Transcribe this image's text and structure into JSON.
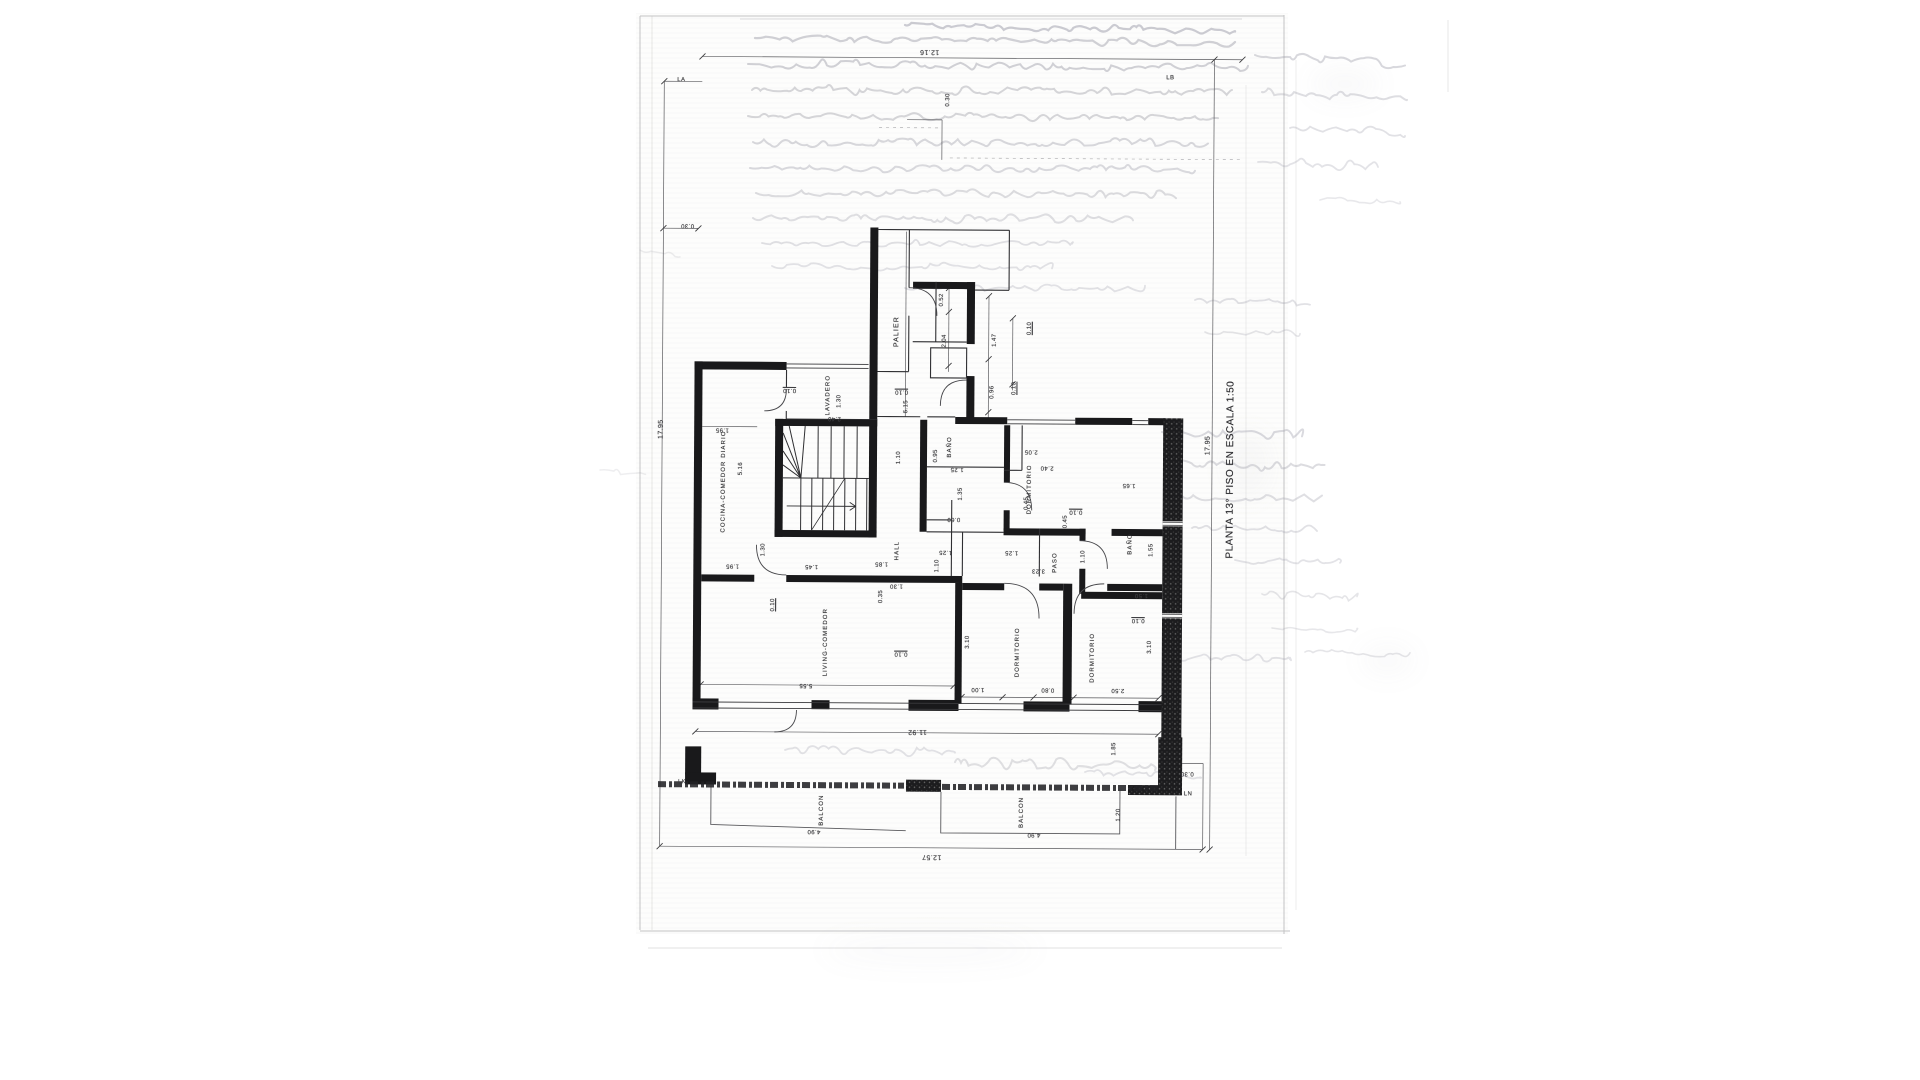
{
  "document": {
    "kind": "scanned architectural floor plan, drawing rotated 90°",
    "title": "PLANTA 13° PISO EN ESCALA 1:50"
  },
  "plan": {
    "rooms": [
      "PALIER",
      "LAVADERO",
      "COCINA-COMEDOR DIARIO",
      "HALL",
      "BAÑO",
      "DORMITORIO",
      "PASO",
      "BAÑO",
      "LIVING-COMEDOR",
      "DORMITORIO",
      "DORMITORIO",
      "BALCON",
      "BALCON"
    ],
    "grid_markers": [
      "LA",
      "LB",
      "LK",
      "LN"
    ],
    "overall_dimensions": [
      "17.95",
      "12.16",
      "11.92",
      "12.57"
    ]
  },
  "annotations": [
    {
      "n": "plan-title",
      "t": "PLANTA 13° PISO EN ESCALA 1:50",
      "x": 1231,
      "y": 468,
      "r": -90,
      "fs": 10,
      "cls": "title"
    },
    {
      "n": "room-label-palier",
      "t": "PALIER",
      "x": 896,
      "y": 332,
      "r": -90,
      "fs": 7,
      "cls": "room"
    },
    {
      "n": "room-label-lavadero",
      "t": "LAVADERO",
      "x": 828,
      "y": 396,
      "r": -90,
      "fs": 6,
      "cls": "room"
    },
    {
      "n": "room-label-cocina-comedor-diario",
      "t": "COCINA-COMEDOR DIARIO",
      "x": 724,
      "y": 483,
      "r": -90,
      "fs": 6,
      "cls": "room"
    },
    {
      "n": "room-label-hall",
      "t": "HALL",
      "x": 898,
      "y": 551,
      "r": -90,
      "fs": 6,
      "cls": "room"
    },
    {
      "n": "room-label-banio-1",
      "t": "BAÑO",
      "x": 950,
      "y": 447,
      "r": -90,
      "fs": 6,
      "cls": "room"
    },
    {
      "n": "room-label-dormitorio-1",
      "t": "DORMITORIO",
      "x": 1030,
      "y": 489,
      "r": -90,
      "fs": 6,
      "cls": "room"
    },
    {
      "n": "room-label-paso",
      "t": "PASO",
      "x": 1056,
      "y": 562,
      "r": -90,
      "fs": 6,
      "cls": "room"
    },
    {
      "n": "room-label-banio-2",
      "t": "BAÑO",
      "x": 1131,
      "y": 543,
      "r": -90,
      "fs": 6,
      "cls": "room"
    },
    {
      "n": "room-label-living-comedor",
      "t": "LIVING-COMEDOR",
      "x": 827,
      "y": 643,
      "r": -90,
      "fs": 6,
      "cls": "room"
    },
    {
      "n": "room-label-dormitorio-2",
      "t": "DORMITORIO",
      "x": 1019,
      "y": 652,
      "r": -90,
      "fs": 6,
      "cls": "room"
    },
    {
      "n": "room-label-dormitorio-3",
      "t": "DORMITORIO",
      "x": 1094,
      "y": 657,
      "r": -90,
      "fs": 6,
      "cls": "room"
    },
    {
      "n": "room-label-balcon-1",
      "t": "BALCON",
      "x": 824,
      "y": 811,
      "r": -90,
      "fs": 6,
      "cls": "room"
    },
    {
      "n": "room-label-balcon-2",
      "t": "BALCON",
      "x": 1024,
      "y": 812,
      "r": -90,
      "fs": 6,
      "cls": "room"
    },
    {
      "n": "grid-marker-la",
      "t": "LA",
      "x": 679,
      "y": 82,
      "r": 0,
      "fs": 6
    },
    {
      "n": "grid-marker-lb",
      "t": "LB",
      "x": 1168,
      "y": 77,
      "r": 0,
      "fs": 6
    },
    {
      "n": "grid-marker-lk",
      "t": "LK",
      "x": 684,
      "y": 784,
      "r": 0,
      "fs": 6
    },
    {
      "n": "grid-marker-ln",
      "t": "LN",
      "x": 1190,
      "y": 793,
      "r": 0,
      "fs": 6
    },
    {
      "n": "dim-overall-left",
      "t": "17.95",
      "x": 661,
      "y": 431,
      "r": -90,
      "fs": 7
    },
    {
      "n": "dim-overall-right",
      "t": "17.95",
      "x": 1208,
      "y": 444,
      "r": -90,
      "fs": 7
    },
    {
      "n": "dim-overall-top",
      "t": "12.16",
      "x": 927,
      "y": 52,
      "r": 180,
      "fs": 7
    },
    {
      "n": "dim-overall-bottom",
      "t": "12.57",
      "x": 934,
      "y": 857,
      "r": 180,
      "fs": 7
    },
    {
      "n": "dim-label",
      "t": "11.92",
      "x": 919,
      "y": 732,
      "r": 180,
      "fs": 7
    },
    {
      "n": "dim-label",
      "t": "0.30",
      "x": 686,
      "y": 227,
      "r": 180,
      "fs": 6
    },
    {
      "n": "dim-label",
      "t": "0.30",
      "x": 946,
      "y": 100,
      "r": -90,
      "fs": 6
    },
    {
      "n": "dim-label",
      "t": "0.52",
      "x": 941,
      "y": 300,
      "r": -90,
      "fs": 6
    },
    {
      "n": "dim-label",
      "t": "2.04",
      "x": 944,
      "y": 341,
      "r": -90,
      "fs": 6
    },
    {
      "n": "dim-label",
      "t": "1.47",
      "x": 994,
      "y": 340,
      "r": -90,
      "fs": 6
    },
    {
      "n": "dim-label",
      "t": "0.10",
      "x": 1029,
      "y": 328,
      "r": -90,
      "fs": 6,
      "u": true
    },
    {
      "n": "dim-label",
      "t": "0.96",
      "x": 992,
      "y": 392,
      "r": -90,
      "fs": 6
    },
    {
      "n": "dim-label",
      "t": "0.10",
      "x": 1014,
      "y": 388,
      "r": -90,
      "fs": 6,
      "u": true
    },
    {
      "n": "dim-label",
      "t": "6.15",
      "x": 906,
      "y": 407,
      "r": -90,
      "fs": 6
    },
    {
      "n": "dim-label",
      "t": "0.10",
      "x": 789,
      "y": 391,
      "r": 180,
      "fs": 6,
      "u": true
    },
    {
      "n": "dim-label",
      "t": "0.10",
      "x": 901,
      "y": 392,
      "r": 180,
      "fs": 6,
      "u": true
    },
    {
      "n": "dim-label",
      "t": "1.30",
      "x": 839,
      "y": 402,
      "r": -90,
      "fs": 6
    },
    {
      "n": "dim-label",
      "t": "2.40",
      "x": 834,
      "y": 419,
      "r": 180,
      "fs": 6
    },
    {
      "n": "dim-label",
      "t": "1.95",
      "x": 722,
      "y": 431,
      "r": 180,
      "fs": 6
    },
    {
      "n": "dim-label",
      "t": "5.16",
      "x": 741,
      "y": 470,
      "r": -90,
      "fs": 6
    },
    {
      "n": "dim-label",
      "t": "1.30",
      "x": 764,
      "y": 551,
      "r": -90,
      "fs": 6
    },
    {
      "n": "dim-label",
      "t": "1.95",
      "x": 733,
      "y": 567,
      "r": 180,
      "fs": 6
    },
    {
      "n": "dim-label",
      "t": "1.45",
      "x": 812,
      "y": 567,
      "r": 180,
      "fs": 6
    },
    {
      "n": "dim-label",
      "t": "1.85",
      "x": 882,
      "y": 564,
      "r": 180,
      "fs": 6
    },
    {
      "n": "dim-label",
      "t": "1.10",
      "x": 899,
      "y": 458,
      "r": -90,
      "fs": 6
    },
    {
      "n": "dim-label",
      "t": "0.95",
      "x": 936,
      "y": 456,
      "r": -90,
      "fs": 6
    },
    {
      "n": "dim-label",
      "t": "1.25",
      "x": 957,
      "y": 469,
      "r": 180,
      "fs": 6
    },
    {
      "n": "dim-label",
      "t": "1.35",
      "x": 961,
      "y": 494,
      "r": -90,
      "fs": 6
    },
    {
      "n": "dim-label",
      "t": "0.60",
      "x": 954,
      "y": 519,
      "r": 180,
      "fs": 6
    },
    {
      "n": "dim-label",
      "t": "1.25",
      "x": 946,
      "y": 552,
      "r": 180,
      "fs": 6
    },
    {
      "n": "dim-label",
      "t": "1.25",
      "x": 1012,
      "y": 552,
      "r": 180,
      "fs": 6
    },
    {
      "n": "dim-label",
      "t": "1.10",
      "x": 938,
      "y": 566,
      "r": -90,
      "fs": 6
    },
    {
      "n": "dim-label",
      "t": "1.30",
      "x": 897,
      "y": 586,
      "r": 180,
      "fs": 6
    },
    {
      "n": "dim-label",
      "t": "0.35",
      "x": 882,
      "y": 597,
      "r": -90,
      "fs": 6
    },
    {
      "n": "dim-label",
      "t": "0.10",
      "x": 774,
      "y": 606,
      "r": -90,
      "fs": 6,
      "u": true
    },
    {
      "n": "dim-label",
      "t": "2.05",
      "x": 1031,
      "y": 451,
      "r": 180,
      "fs": 6
    },
    {
      "n": "dim-label",
      "t": "2.40",
      "x": 1047,
      "y": 467,
      "r": 180,
      "fs": 6
    },
    {
      "n": "dim-label",
      "t": "0.45",
      "x": 1027,
      "y": 503,
      "r": -90,
      "fs": 6
    },
    {
      "n": "dim-label",
      "t": "1.65",
      "x": 1129,
      "y": 484,
      "r": 180,
      "fs": 6
    },
    {
      "n": "dim-label",
      "t": "0.10",
      "x": 1076,
      "y": 511,
      "r": 180,
      "fs": 6,
      "u": true
    },
    {
      "n": "dim-label",
      "t": "0.45",
      "x": 1066,
      "y": 521,
      "r": -90,
      "fs": 6
    },
    {
      "n": "dim-label",
      "t": "1.10",
      "x": 1084,
      "y": 556,
      "r": -90,
      "fs": 6
    },
    {
      "n": "dim-label",
      "t": "1.55",
      "x": 1152,
      "y": 549,
      "r": -90,
      "fs": 6
    },
    {
      "n": "dim-label",
      "t": "3.23",
      "x": 1039,
      "y": 570,
      "r": 180,
      "fs": 6
    },
    {
      "n": "dim-label",
      "t": "1.50",
      "x": 1142,
      "y": 594,
      "r": 180,
      "fs": 6
    },
    {
      "n": "dim-label",
      "t": "0.10",
      "x": 1139,
      "y": 619,
      "r": 180,
      "fs": 6,
      "u": true
    },
    {
      "n": "dim-label",
      "t": "3.10",
      "x": 969,
      "y": 642,
      "r": -90,
      "fs": 6
    },
    {
      "n": "dim-label",
      "t": "3.10",
      "x": 1151,
      "y": 646,
      "r": -90,
      "fs": 6
    },
    {
      "n": "dim-label",
      "t": "0.10",
      "x": 902,
      "y": 654,
      "r": 180,
      "fs": 6,
      "u": true
    },
    {
      "n": "dim-label",
      "t": "5.55",
      "x": 807,
      "y": 686,
      "r": 180,
      "fs": 6
    },
    {
      "n": "dim-label",
      "t": "1.00",
      "x": 979,
      "y": 689,
      "r": 180,
      "fs": 6
    },
    {
      "n": "dim-label",
      "t": "0.80",
      "x": 1049,
      "y": 689,
      "r": 180,
      "fs": 6
    },
    {
      "n": "dim-label",
      "t": "2.50",
      "x": 1119,
      "y": 689,
      "r": 180,
      "fs": 6
    },
    {
      "n": "dim-label",
      "t": "1.85",
      "x": 1116,
      "y": 748,
      "r": -90,
      "fs": 6
    },
    {
      "n": "dim-label",
      "t": "1.20",
      "x": 1121,
      "y": 814,
      "r": -90,
      "fs": 6
    },
    {
      "n": "dim-label",
      "t": "0.30",
      "x": 1189,
      "y": 772,
      "r": 180,
      "fs": 6
    },
    {
      "n": "dim-label",
      "t": "4.90",
      "x": 816,
      "y": 832,
      "r": 180,
      "fs": 6
    },
    {
      "n": "dim-label",
      "t": "4.90",
      "x": 1036,
      "y": 834,
      "r": 180,
      "fs": 6
    }
  ]
}
